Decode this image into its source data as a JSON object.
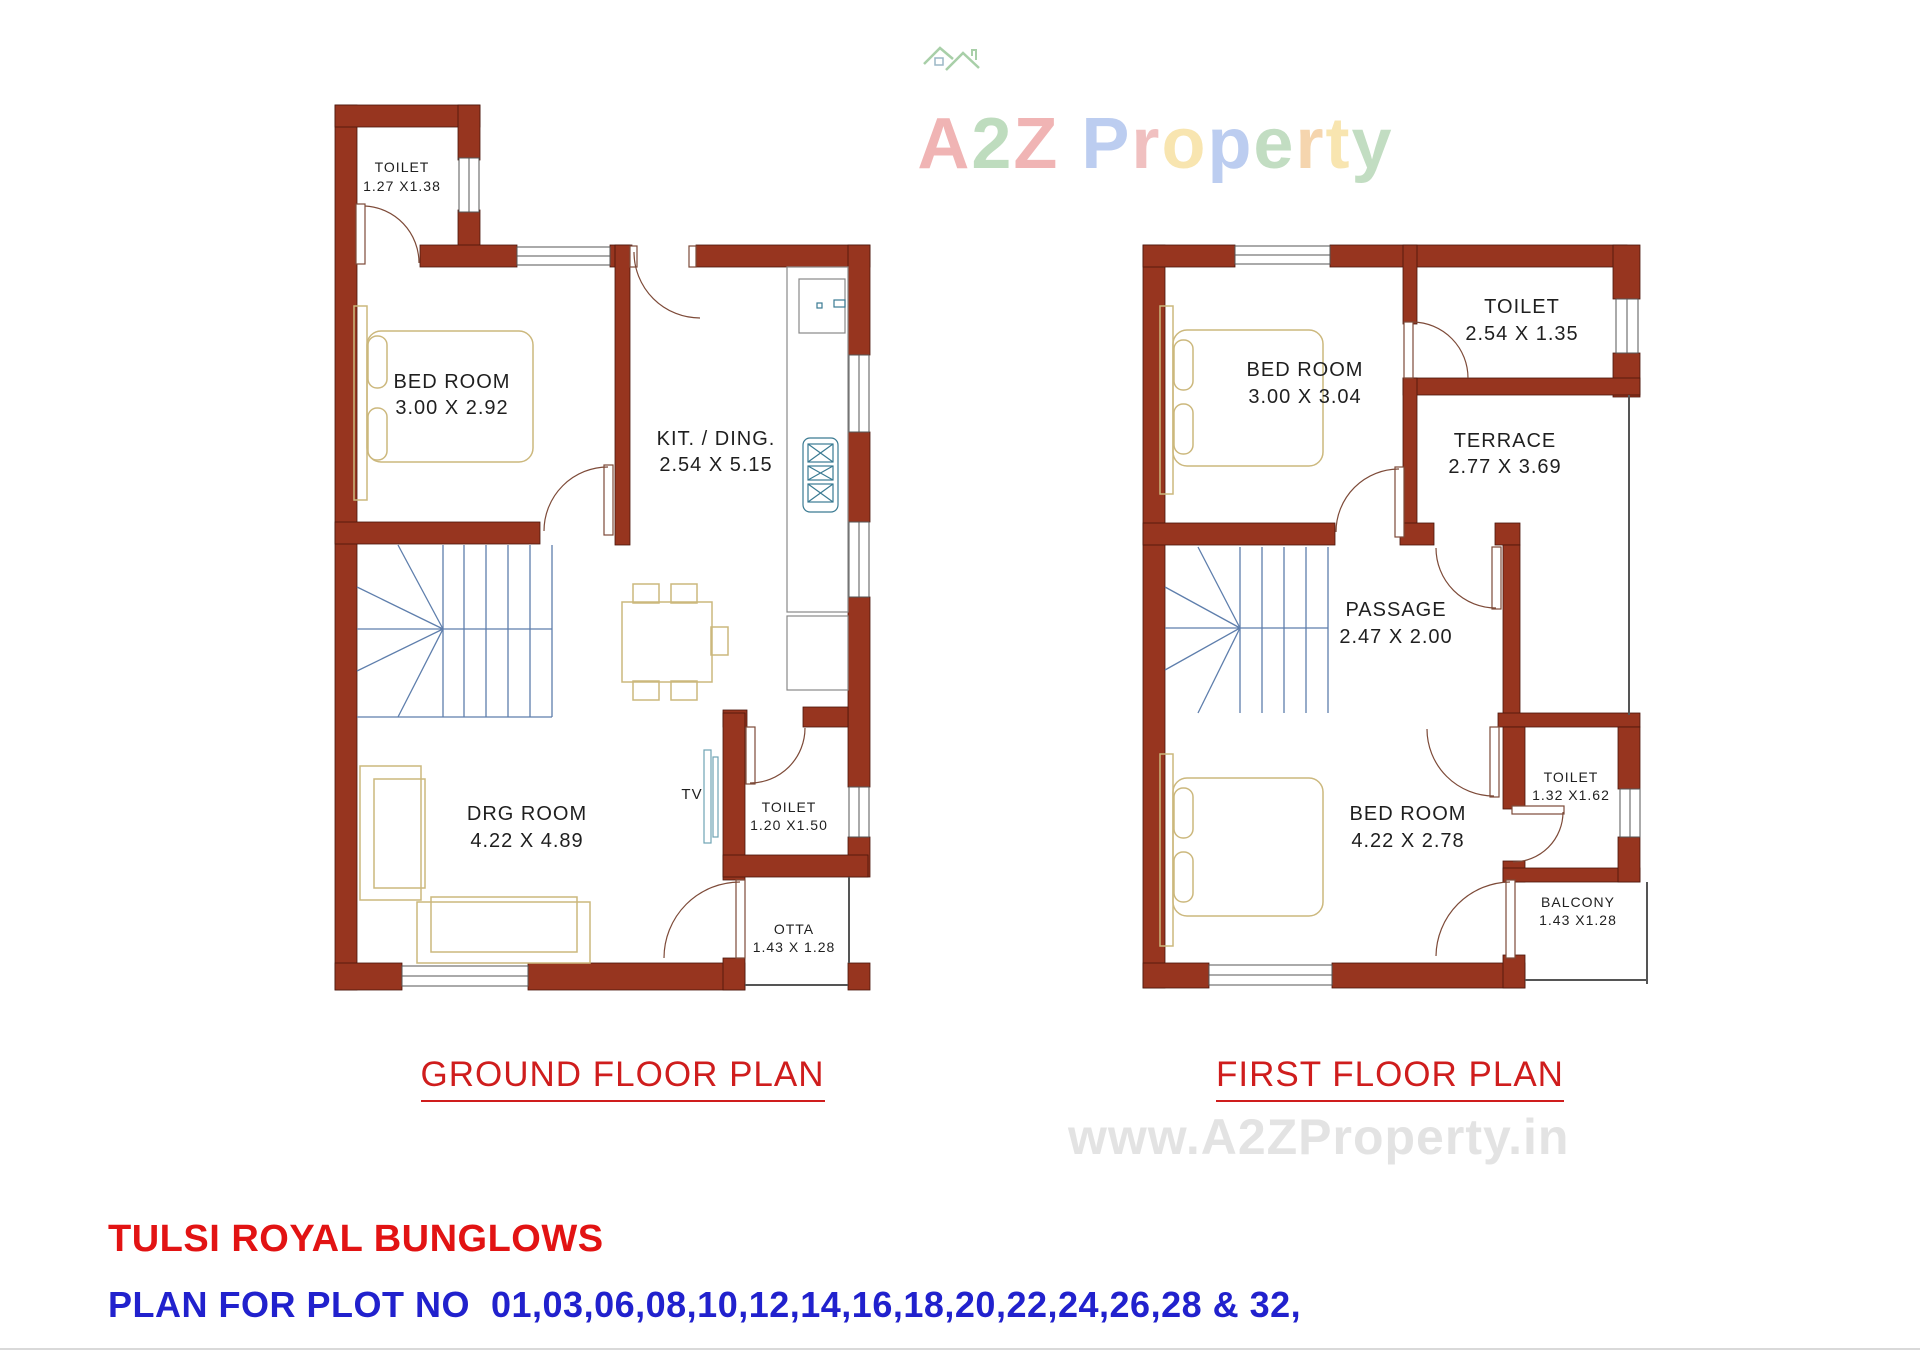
{
  "logo": {
    "text": "A2Z Property",
    "letters": [
      {
        "ch": "A",
        "color": "#f0b4b4"
      },
      {
        "ch": "2",
        "color": "#bedcbe"
      },
      {
        "ch": "Z",
        "color": "#f0b4b4"
      },
      {
        "ch": " ",
        "color": "#ffffff"
      },
      {
        "ch": "P",
        "color": "#bccdf0"
      },
      {
        "ch": "r",
        "color": "#f0c0c0"
      },
      {
        "ch": "o",
        "color": "#f8e5b0"
      },
      {
        "ch": "p",
        "color": "#bccdf0"
      },
      {
        "ch": "e",
        "color": "#c2ddc2"
      },
      {
        "ch": "r",
        "color": "#f5d5ae"
      },
      {
        "ch": "t",
        "color": "#f8e5b0"
      },
      {
        "ch": "y",
        "color": "#c2ddc2"
      }
    ],
    "house_icon_color": "#a8cfa8"
  },
  "ground_floor": {
    "caption": "GROUND FLOOR PLAN",
    "rooms": {
      "toilet_top": {
        "name": "TOILET",
        "dims": "1.27 X1.38"
      },
      "bedroom": {
        "name": "BED ROOM",
        "dims": "3.00 X 2.92"
      },
      "kitchen": {
        "name": "KIT. / DING.",
        "dims": "2.54 X 5.15"
      },
      "drawing_room": {
        "name": "DRG ROOM",
        "dims": "4.22 X 4.89"
      },
      "toilet_bottom": {
        "name": "TOILET",
        "dims": "1.20 X1.50"
      },
      "otta": {
        "name": "OTTA",
        "dims": "1.43 X 1.28"
      },
      "tv": "TV"
    }
  },
  "first_floor": {
    "caption": "FIRST FLOOR PLAN",
    "rooms": {
      "bedroom1": {
        "name": "BED ROOM",
        "dims": "3.00 X 3.04"
      },
      "toilet1": {
        "name": "TOILET",
        "dims": "2.54 X 1.35"
      },
      "terrace": {
        "name": "TERRACE",
        "dims": "2.77 X 3.69"
      },
      "passage": {
        "name": "PASSAGE",
        "dims": "2.47 X 2.00"
      },
      "bedroom2": {
        "name": "BED ROOM",
        "dims": "4.22 X 2.78"
      },
      "toilet2": {
        "name": "TOILET",
        "dims": "1.32 X1.62"
      },
      "balcony": {
        "name": "BALCONY",
        "dims": "1.43 X1.28"
      }
    }
  },
  "watermark": "www.A2ZProperty.in",
  "footer": {
    "project_title": "TULSI ROYAL BUNGLOWS",
    "plot_line": "PLAN FOR PLOT NO  01,03,06,08,10,12,14,16,18,20,22,24,26,28 & 32,"
  },
  "colors": {
    "wall": "#97351f",
    "stair": "#5e7eac",
    "furniture": "#ccb87d",
    "fixture": "#3a7a92",
    "caption_red": "#cf1d1d",
    "footer_red": "#e21313",
    "footer_blue": "#2121cd",
    "watermark_gray": "#e3e3e3"
  }
}
